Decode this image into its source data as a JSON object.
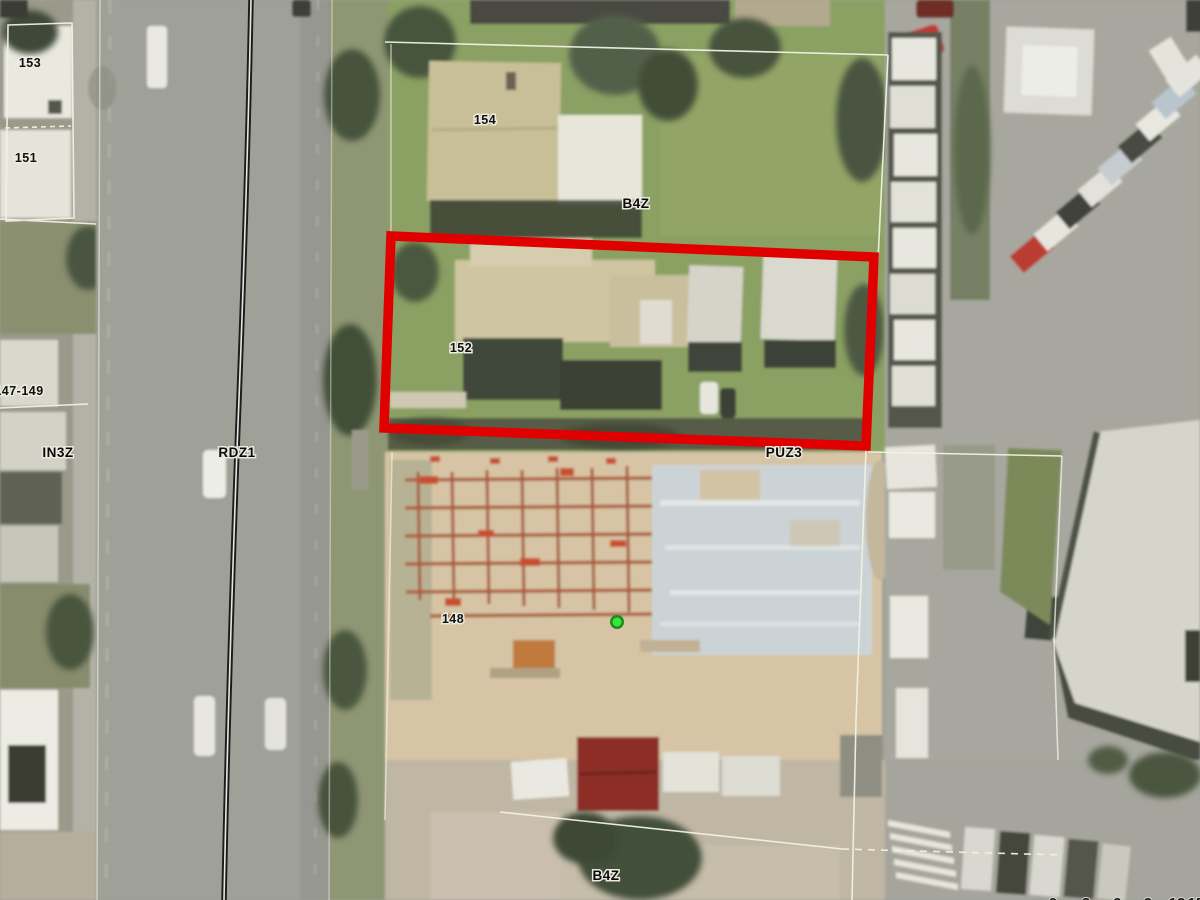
{
  "map": {
    "parcel_labels": {
      "p153": "153",
      "p151": "151",
      "p154": "154",
      "p152": "152",
      "p147_149": "147-149",
      "p148": "148"
    },
    "zone_labels": {
      "b4z_north": "B4Z",
      "in3z": "IN3Z",
      "rdz1": "RDZ1",
      "puz3": "PUZ3",
      "b4z_south": "B4Z"
    },
    "scale_bar": {
      "ticks": [
        "0",
        "3",
        "6",
        "9",
        "12",
        "15"
      ]
    },
    "highlight": {
      "parcel": "152",
      "color": "#e10000"
    },
    "marker": {
      "fill": "#38e838",
      "ring": "#1e8a1e"
    },
    "boundary_color": "#f2f2e4"
  }
}
